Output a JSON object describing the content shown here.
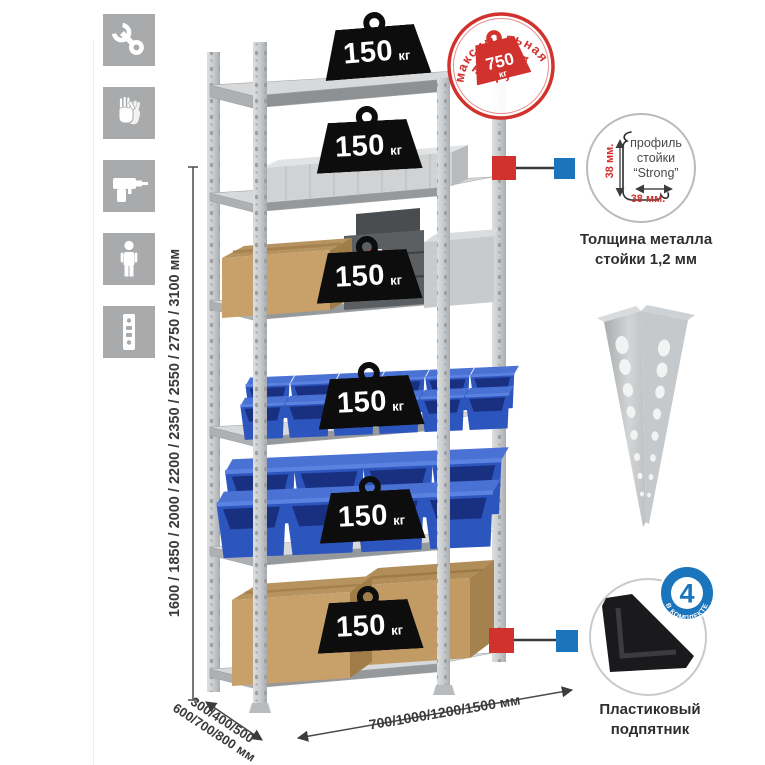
{
  "page": {
    "background": "#ffffff"
  },
  "colors": {
    "accent_red": "#d2322e",
    "accent_blue": "#1b75bc",
    "bin_blue": "#2d55be",
    "steel_gray": "#c9cccf",
    "icon_tile_gray": "#a8aaac",
    "text_dark": "#3a3a3c"
  },
  "icons": {
    "left_column": [
      {
        "name": "wrench-icon"
      },
      {
        "name": "gloves-icon"
      },
      {
        "name": "drill-icon"
      },
      {
        "name": "person-icon"
      },
      {
        "name": "rack-post-icon"
      }
    ]
  },
  "rack": {
    "shelves_count": 6,
    "weights": [
      {
        "value": "150",
        "unit": "кг"
      },
      {
        "value": "150",
        "unit": "кг"
      },
      {
        "value": "150",
        "unit": "кг"
      },
      {
        "value": "150",
        "unit": "кг"
      },
      {
        "value": "150",
        "unit": "кг"
      },
      {
        "value": "150",
        "unit": "кг"
      }
    ]
  },
  "stamp": {
    "arc_top": "максимальная",
    "arc_bottom": "нагрузка",
    "value": "750",
    "unit": "кг"
  },
  "dimensions": {
    "height": "1600 / 1850 / 2000 / 2200 / 2350 / 2550 / 2750 / 3100 мм",
    "depth_line1": "300/400/500",
    "depth_line2": "600/700/800 мм",
    "width": "700/1000/1200/1500 мм"
  },
  "profile_callout": {
    "label_line1": "профиль",
    "label_line2": "стойки",
    "label_line3": "“Strong”",
    "dim_vertical": "38 мм.",
    "dim_horizontal": "38 мм.",
    "caption_line1": "Толщина металла",
    "caption_line2": "стойки 1,2 мм"
  },
  "foot_callout": {
    "badge_value": "4",
    "badge_arc": "В КОМПЛЕКТЕ",
    "caption_line1": "Пластиковый",
    "caption_line2": "подпятник"
  }
}
